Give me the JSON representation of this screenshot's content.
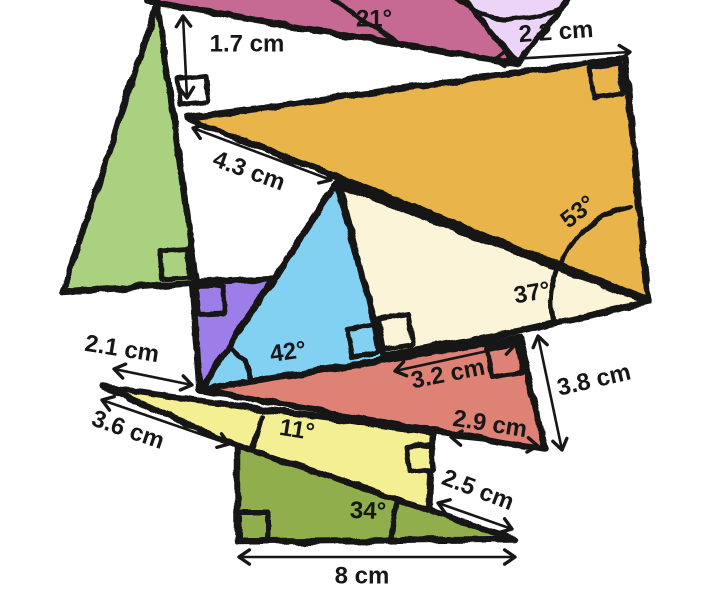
{
  "canvas": {
    "width": 724,
    "height": 590,
    "background": "#ffffff",
    "stroke_color": "#171717"
  },
  "diagram": {
    "shapes": [
      {
        "name": "triangle-pink",
        "fill": "#c76a93",
        "points": [
          [
            138,
            -22
          ],
          [
            148,
            2
          ],
          [
            517,
            64
          ],
          [
            449,
            -22
          ]
        ]
      },
      {
        "name": "triangle-lavender",
        "fill": "#ecd3f8",
        "points": [
          [
            517,
            64
          ],
          [
            446,
            -22
          ],
          [
            586,
            -22
          ]
        ]
      },
      {
        "name": "triangle-green",
        "fill": "#aad180",
        "points": [
          [
            158,
            2
          ],
          [
            63,
            292
          ],
          [
            196,
            283
          ]
        ]
      },
      {
        "name": "triangle-orange",
        "fill": "#e9b54b",
        "points": [
          [
            187,
            118
          ],
          [
            625,
            58
          ],
          [
            648,
            300
          ]
        ]
      },
      {
        "name": "triangle-cream",
        "fill": "#fbf4d9",
        "points": [
          [
            340,
            185
          ],
          [
            648,
            302
          ],
          [
            516,
            332
          ],
          [
            380,
            356
          ]
        ]
      },
      {
        "name": "triangle-purple",
        "fill": "#9d7de8",
        "points": [
          [
            192,
            282
          ],
          [
            274,
            278
          ],
          [
            200,
            390
          ]
        ]
      },
      {
        "name": "triangle-blue",
        "fill": "#82d1f2",
        "points": [
          [
            337,
            183
          ],
          [
            200,
            390
          ],
          [
            385,
            359
          ]
        ]
      },
      {
        "name": "triangle-red",
        "fill": "#de8276",
        "points": [
          [
            200,
            390
          ],
          [
            520,
            338
          ],
          [
            545,
            450
          ]
        ]
      },
      {
        "name": "triangle-olive",
        "fill": "#90ae4b",
        "points": [
          [
            237,
            445
          ],
          [
            237,
            542
          ],
          [
            514,
            539
          ]
        ]
      },
      {
        "name": "triangle-yellow",
        "fill": "#f4ef92",
        "points": [
          [
            103,
            387
          ],
          [
            433,
            433
          ],
          [
            429,
            510
          ],
          [
            238,
            446
          ]
        ]
      }
    ],
    "right_angle_markers": [
      {
        "name": "right-angle-marker-white-1-7",
        "fill": "#ffffff",
        "points": [
          [
            178,
            79
          ],
          [
            205,
            76
          ],
          [
            208,
            102
          ],
          [
            181,
            105
          ]
        ]
      },
      {
        "name": "right-angle-marker-green",
        "fill": "#aad180",
        "points": [
          [
            190,
            277
          ],
          [
            162,
            279
          ],
          [
            160,
            251
          ],
          [
            188,
            249
          ]
        ]
      },
      {
        "name": "right-angle-marker-purple",
        "fill": "#9d7de8",
        "points": [
          [
            196,
            287
          ],
          [
            223,
            286
          ],
          [
            225,
            313
          ],
          [
            198,
            314
          ]
        ]
      },
      {
        "name": "right-angle-marker-orange",
        "fill": "#e9b54b",
        "points": [
          [
            620,
            64
          ],
          [
            590,
            68
          ],
          [
            593,
            98
          ],
          [
            623,
            94
          ]
        ]
      },
      {
        "name": "right-angle-marker-blue",
        "fill": "#82d1f2",
        "points": [
          [
            347,
            330
          ],
          [
            374,
            325
          ],
          [
            379,
            352
          ],
          [
            352,
            357
          ]
        ]
      },
      {
        "name": "right-angle-marker-cream",
        "fill": "#fbf4d9",
        "points": [
          [
            378,
            319
          ],
          [
            408,
            314
          ],
          [
            413,
            344
          ],
          [
            383,
            349
          ]
        ]
      },
      {
        "name": "right-angle-marker-red",
        "fill": "#de8276",
        "points": [
          [
            516,
            344
          ],
          [
            487,
            349
          ],
          [
            493,
            377
          ],
          [
            522,
            372
          ]
        ]
      },
      {
        "name": "right-angle-marker-yellow",
        "fill": "#f4ef92",
        "points": [
          [
            406,
            447
          ],
          [
            431,
            444
          ],
          [
            434,
            469
          ],
          [
            409,
            472
          ]
        ]
      },
      {
        "name": "right-angle-marker-olive",
        "fill": "#90ae4b",
        "points": [
          [
            240,
            512
          ],
          [
            268,
            512
          ],
          [
            268,
            540
          ],
          [
            240,
            540
          ]
        ]
      }
    ],
    "angle_arcs": [
      {
        "name": "angle-line-21",
        "type": "line",
        "x1": 328,
        "y1": -4,
        "x2": 402,
        "y2": 46
      },
      {
        "name": "angle-arc-lavender",
        "type": "curve",
        "d": "M455,-2 Q500,34 562,8"
      },
      {
        "name": "angle-arc-53",
        "type": "arc",
        "cx": 648,
        "cy": 300,
        "r": 95,
        "a1": -100,
        "a2": -159
      },
      {
        "name": "angle-arc-37",
        "type": "arc",
        "cx": 648,
        "cy": 302,
        "r": 97,
        "a1": -160,
        "a2": -192
      },
      {
        "name": "angle-arc-42",
        "type": "arc",
        "cx": 200,
        "cy": 390,
        "r": 52,
        "a1": -57,
        "a2": -9
      },
      {
        "name": "angle-arc-11",
        "type": "arc",
        "cx": 104,
        "cy": 388,
        "r": 160,
        "a1": 10,
        "a2": 21.5
      },
      {
        "name": "angle-arc-34",
        "type": "arc",
        "cx": 514,
        "cy": 539,
        "r": 122,
        "a1": -162,
        "a2": -179
      }
    ],
    "dimension_arrows": [
      {
        "name": "dim-arrow-1-7-cm",
        "x1": 183,
        "y1": 16,
        "x2": 187,
        "y2": 98
      },
      {
        "name": "dim-arrow-2-2-cm",
        "x1": 494,
        "y1": 60,
        "x2": 630,
        "y2": 52
      },
      {
        "name": "dim-arrow-4-3-cm",
        "x1": 193,
        "y1": 128,
        "x2": 331,
        "y2": 180
      },
      {
        "name": "dim-arrow-2-1-cm",
        "x1": 114,
        "y1": 369,
        "x2": 192,
        "y2": 385
      },
      {
        "name": "dim-arrow-3-6-cm",
        "x1": 102,
        "y1": 400,
        "x2": 229,
        "y2": 444
      },
      {
        "name": "dim-arrow-3-2-cm",
        "x1": 395,
        "y1": 371,
        "x2": 515,
        "y2": 345
      },
      {
        "name": "dim-arrow-2-9-cm",
        "x1": 451,
        "y1": 437,
        "x2": 538,
        "y2": 446
      },
      {
        "name": "dim-arrow-3-8-cm",
        "x1": 538,
        "y1": 336,
        "x2": 562,
        "y2": 450
      },
      {
        "name": "dim-arrow-2-5-cm",
        "x1": 438,
        "y1": 503,
        "x2": 512,
        "y2": 529
      },
      {
        "name": "dim-arrow-8-cm",
        "x1": 239,
        "y1": 557,
        "x2": 515,
        "y2": 557
      }
    ],
    "labels": [
      {
        "name": "label-angle-21",
        "text": "21°",
        "x": 374,
        "y": 19,
        "rot": 0
      },
      {
        "name": "label-2-2-cm",
        "text": "2.2 cm",
        "x": 556,
        "y": 32,
        "rot": -4
      },
      {
        "name": "label-1-7-cm",
        "text": "1.7 cm",
        "x": 247,
        "y": 44,
        "rot": 0
      },
      {
        "name": "label-4-3-cm",
        "text": "4.3 cm",
        "x": 249,
        "y": 171,
        "rot": 20
      },
      {
        "name": "label-angle-53",
        "text": "53°",
        "x": 578,
        "y": 212,
        "rot": -38
      },
      {
        "name": "label-angle-37",
        "text": "37°",
        "x": 532,
        "y": 293,
        "rot": -10
      },
      {
        "name": "label-angle-42",
        "text": "42°",
        "x": 288,
        "y": 352,
        "rot": -8
      },
      {
        "name": "label-2-1-cm",
        "text": "2.1 cm",
        "x": 122,
        "y": 349,
        "rot": 9
      },
      {
        "name": "label-3-6-cm",
        "text": "3.6 cm",
        "x": 128,
        "y": 430,
        "rot": 19
      },
      {
        "name": "label-3-2-cm",
        "text": "3.2 cm",
        "x": 448,
        "y": 374,
        "rot": -11
      },
      {
        "name": "label-2-9-cm",
        "text": "2.9 cm",
        "x": 490,
        "y": 424,
        "rot": 9
      },
      {
        "name": "label-3-8-cm",
        "text": "3.8 cm",
        "x": 594,
        "y": 380,
        "rot": -13
      },
      {
        "name": "label-angle-11",
        "text": "11°",
        "x": 297,
        "y": 430,
        "rot": 9
      },
      {
        "name": "label-2-5-cm",
        "text": "2.5 cm",
        "x": 478,
        "y": 490,
        "rot": 21
      },
      {
        "name": "label-angle-34",
        "text": "34°",
        "x": 368,
        "y": 511,
        "rot": 2
      },
      {
        "name": "label-8-cm",
        "text": "8 cm",
        "x": 362,
        "y": 576,
        "rot": 0
      }
    ]
  }
}
